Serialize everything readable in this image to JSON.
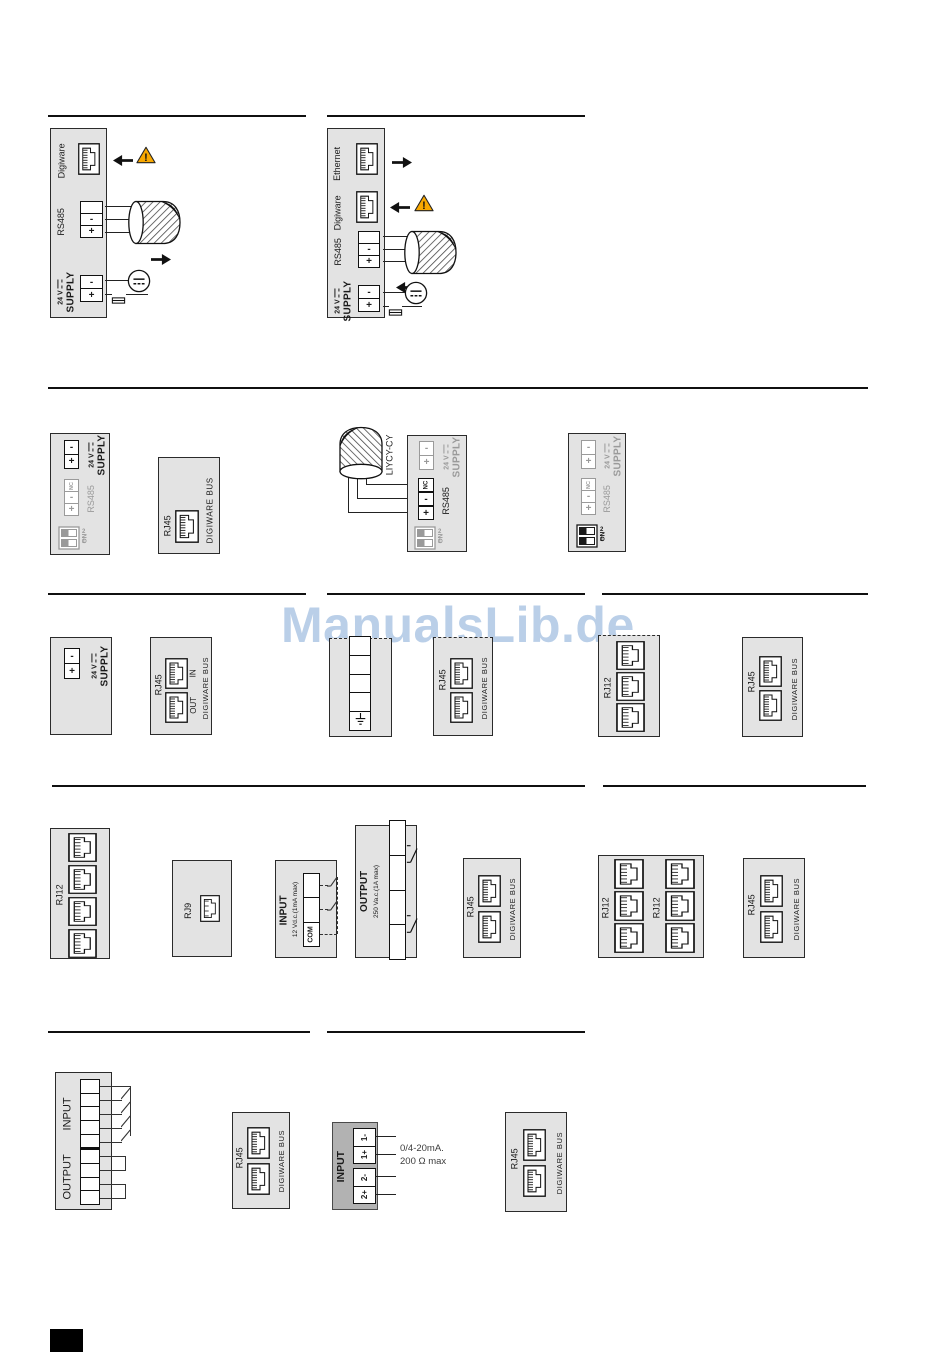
{
  "watermark": {
    "text": "ManualsLib.de",
    "color": "#82a7d6"
  },
  "labels": {
    "digiware": "Digiware",
    "ethernet": "Ethernet",
    "rs485": "RS485",
    "volt24": "24 V",
    "supply": "SUPPLY",
    "minus": "-",
    "plus": "+",
    "nc": "NC",
    "dip1": "1",
    "dip2": "2",
    "on": "ON",
    "rj45": "RJ45",
    "rj12": "RJ12",
    "rj9": "RJ9",
    "digiware_bus": "DIGIWARE BUS",
    "in": "IN",
    "out": "OUT",
    "input": "INPUT",
    "output": "OUTPUT",
    "com": "COM",
    "cable_type": "LIYCY-CY",
    "input_rating": "12 Vd.c.(1mA max)",
    "output_rating": "250 Va.c.(1A max)",
    "analog_terminals": [
      "1-",
      "1+",
      "2-",
      "2+"
    ],
    "analog_note1": "0/4-20mA.",
    "analog_note2": "200 Ω max"
  },
  "colors": {
    "panel": "#e3e3e3",
    "panel_dark": "#b2b2b2",
    "inactive": "#9a9a9a",
    "warning": "#F9A800",
    "watermark": "#82a7d6"
  }
}
